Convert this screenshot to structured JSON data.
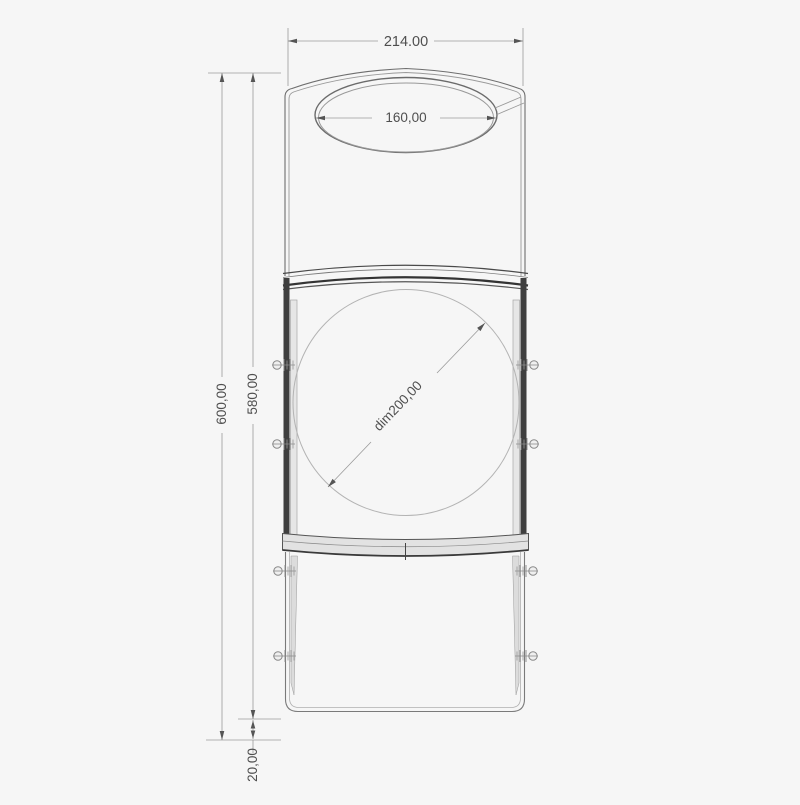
{
  "drawing": {
    "kind": "cad-technical-drawing",
    "view": "front-elevation-with-dimensions",
    "labels": {
      "top_width": "214.00",
      "opening_width": "160,00",
      "overall_height": "600,00",
      "body_height": "580,00",
      "bottom_offset": "20,00",
      "circle_diameter": "dim200,00"
    },
    "colors": {
      "background": "#f6f6f6",
      "line_dark": "#3a3a3a",
      "line_medium": "#6e6e6e",
      "line_light": "#a8a8a8",
      "dimension_text": "#4f4f4f",
      "panel_fill": "#e2e2e2",
      "side_bar_fill": "#3f3f3f"
    }
  }
}
